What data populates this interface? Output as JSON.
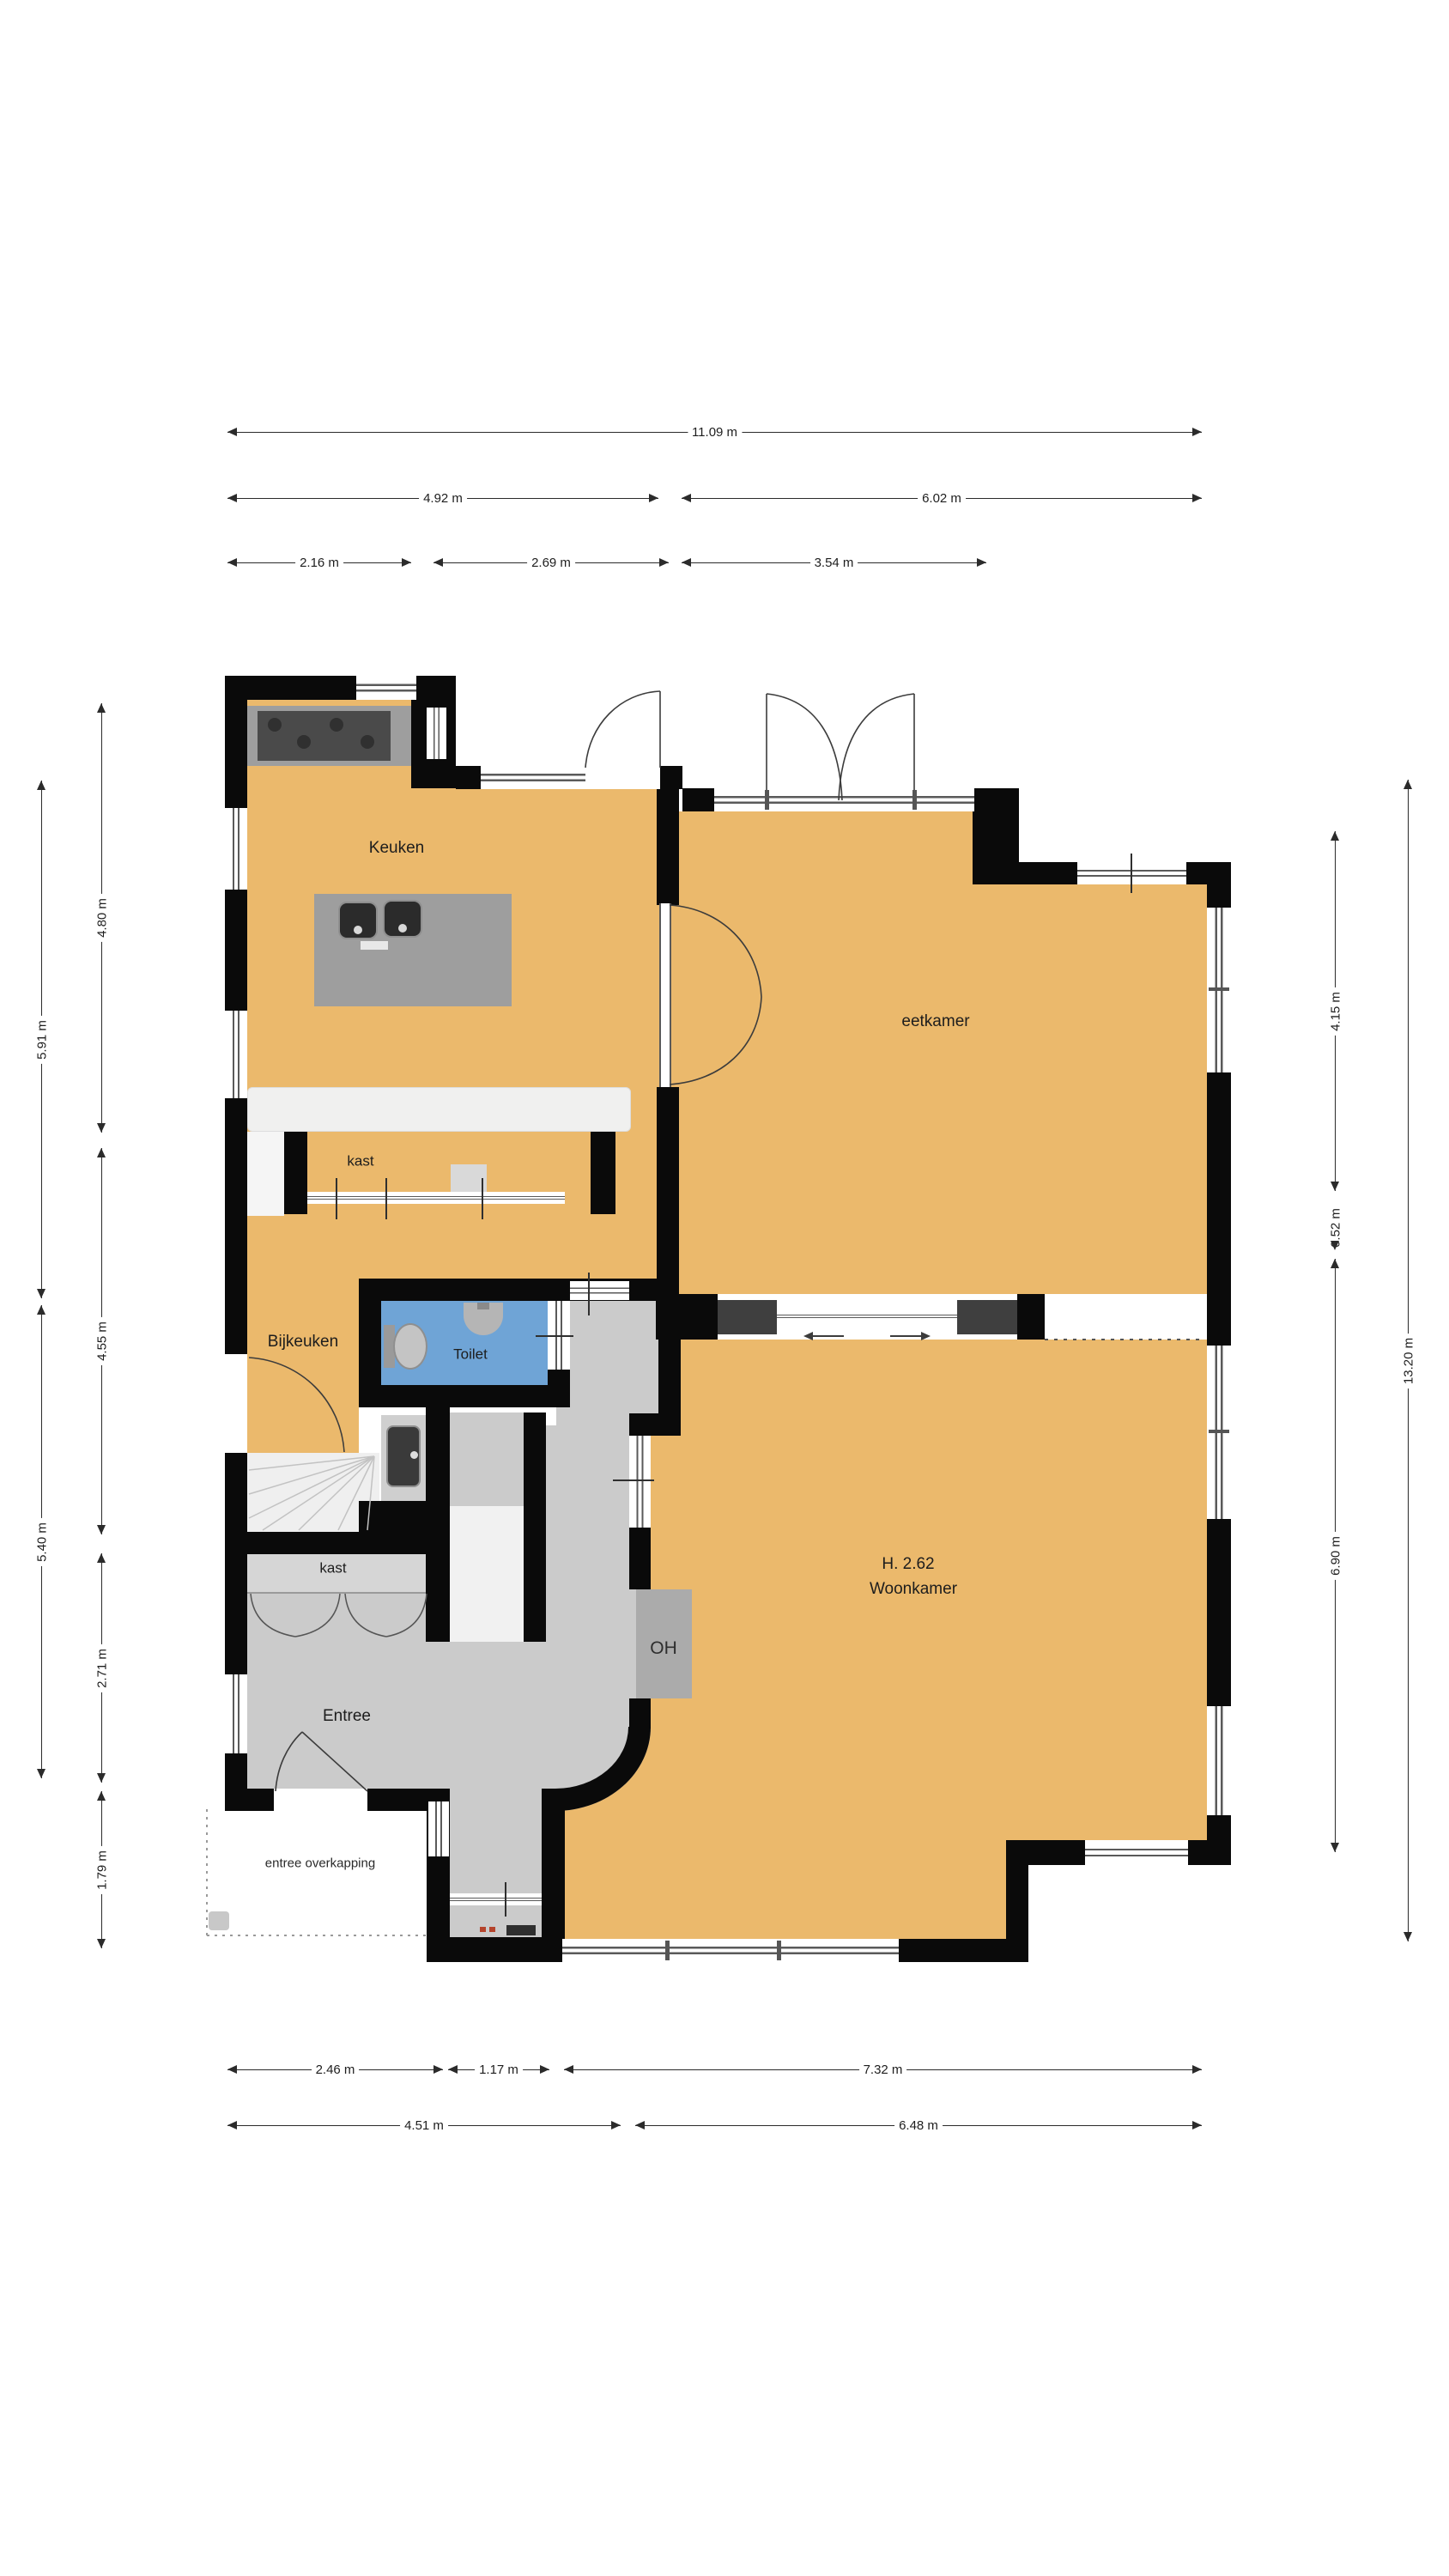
{
  "plan_title": "floor plan ground floor",
  "rooms": {
    "keuken": "Keuken",
    "eetkamer": "eetkamer",
    "kast_top": "kast",
    "bijkeuken": "Bijkeuken",
    "toilet": "Toilet",
    "kast_bottom": "kast",
    "entree": "Entree",
    "overkapping": "entree overkapping",
    "woonkamer_height": "H. 2.62",
    "woonkamer": "Woonkamer",
    "oh": "OH"
  },
  "dims": {
    "t1": "11.09 m",
    "t2": "4.92 m",
    "t3": "6.02 m",
    "t4": "2.16 m",
    "t5": "2.69 m",
    "t6": "3.54 m",
    "l1": "5.91 m",
    "l2": "5.40 m",
    "l3": "4.80 m",
    "l4": "4.55 m",
    "l5": "2.71 m",
    "l6": "1.79 m",
    "r1": "4.15 m",
    "r2": "0.52 m",
    "r3": "6.90 m",
    "r4": "13.20 m",
    "b1": "2.46 m",
    "b2": "1.17 m",
    "b3": "7.32 m",
    "b4": "4.51 m",
    "b5": "6.48 m"
  },
  "colors": {
    "floor": "#EBB96C",
    "wall": "#0A0A0A",
    "hall": "#CBCBCB",
    "closet": "#D6D6D6",
    "toilet_floor": "#6FA4D6",
    "counter": "#9E9E9E",
    "stove": "#4A4A4A",
    "fixture_dark": "#3F3F3F",
    "cabinet": "#F0F0EF",
    "stairs": "#F1F1F1",
    "oh_block": "#ABABAB",
    "window_line": "#5A5A5A",
    "mat_red": "#B5442C",
    "dim_line": "#2B2B2B"
  }
}
